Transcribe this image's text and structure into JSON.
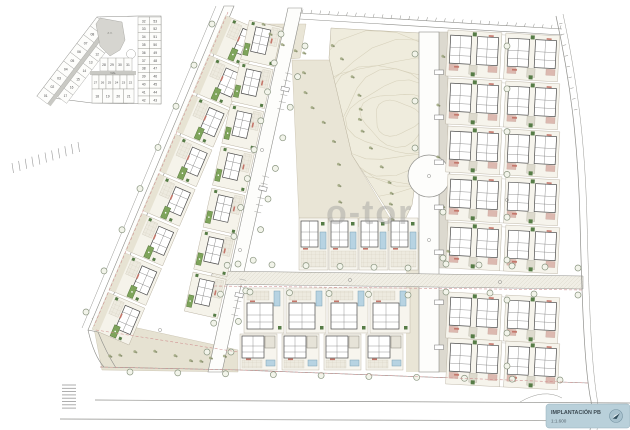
{
  "drawing": {
    "type_label": "site implantation plan",
    "watermark": {
      "text": "o-tor"
    }
  },
  "key_plan": {
    "left_outer_plots": [
      "01",
      "02",
      "03",
      "04",
      "05",
      "06",
      "07",
      "08",
      "09"
    ],
    "left_inner_plots": [
      "17",
      "16",
      "15",
      "14",
      "13",
      "12",
      "11",
      "10"
    ],
    "row_top": [
      "28",
      "29",
      "30",
      "31"
    ],
    "row_mid": [
      "27",
      "26",
      "25",
      "24",
      "23",
      "22"
    ],
    "row_bottom": [
      "18",
      "19",
      "20",
      "21"
    ],
    "right_col_left": [
      "32",
      "33",
      "34",
      "35",
      "36",
      "37",
      "38",
      "39",
      "40",
      "41",
      "42"
    ],
    "right_col_right": [
      "53",
      "52",
      "51",
      "50",
      "49",
      "48",
      "47",
      "46",
      "45",
      "44",
      "43"
    ],
    "road_label": "VIAL",
    "green_zone_label": "Z.V."
  },
  "title_block": {
    "title": "IMPLANTACIÓN PB",
    "scale": "1:1.600"
  },
  "colors": {
    "pool_green": "#7ea45b",
    "pool_blue": "#b7d3e2",
    "park_beige": "#efecdd",
    "ground_beige": "#e7e3d3",
    "title_bg": "#b9d0da",
    "label_red": "#c4766a",
    "road_edge": "#8f8f8b",
    "wall": "#4a4a4a"
  }
}
